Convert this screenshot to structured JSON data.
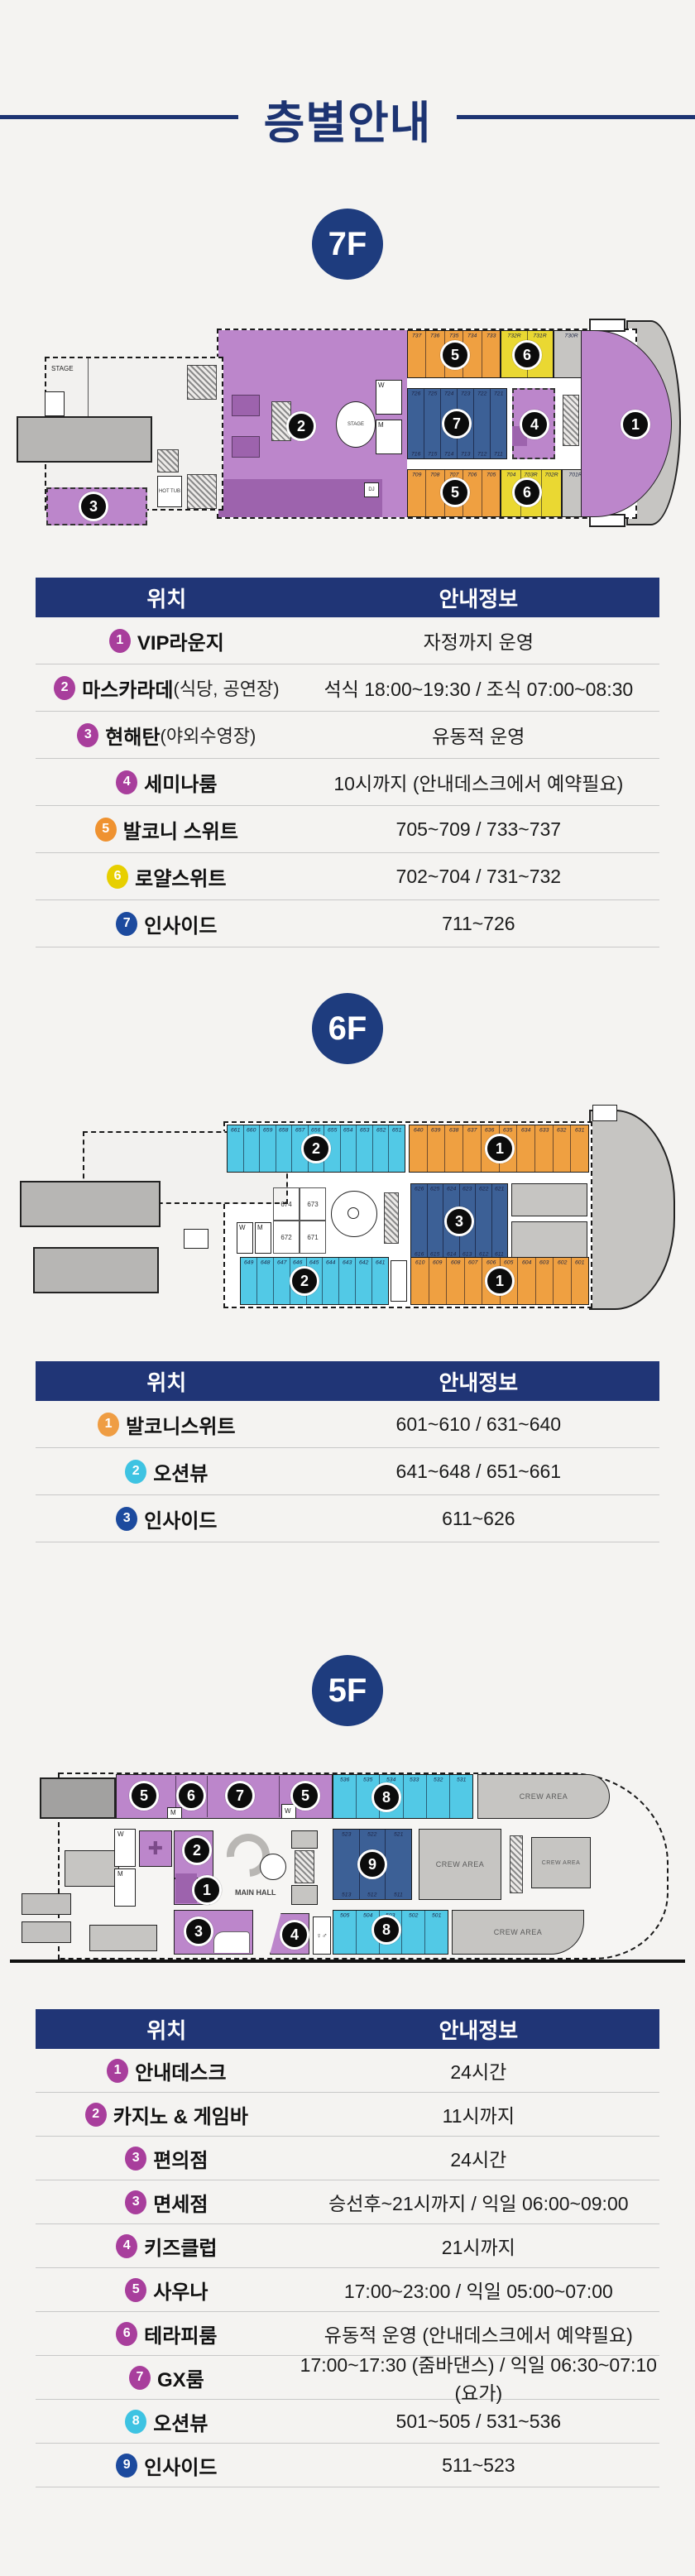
{
  "page": {
    "title": "층별안내"
  },
  "table_headers": {
    "location": "위치",
    "info": "안내정보"
  },
  "decks": {
    "f7": {
      "badge": "7F",
      "rows": [
        {
          "num": "1",
          "color": "#a83e9c",
          "name": "VIP라운지",
          "sub": "",
          "info": "자정까지 운영"
        },
        {
          "num": "2",
          "color": "#a83e9c",
          "name": "마스카라데",
          "sub": "(식당, 공연장)",
          "info": "석식 18:00~19:30 / 조식 07:00~08:30"
        },
        {
          "num": "3",
          "color": "#a83e9c",
          "name": "현해탄",
          "sub": "(야외수영장)",
          "info": "유동적 운영"
        },
        {
          "num": "4",
          "color": "#a83e9c",
          "name": "세미나룸",
          "sub": "",
          "info": "10시까지 (안내데스크에서 예약필요)"
        },
        {
          "num": "5",
          "color": "#ef9230",
          "name": "발코니 스위트",
          "sub": "",
          "info": "705~709 / 733~737"
        },
        {
          "num": "6",
          "color": "#e7cf00",
          "name": "로얄스위트",
          "sub": "",
          "info": "702~704 / 731~732"
        },
        {
          "num": "7",
          "color": "#1c4a9e",
          "name": "인사이드",
          "sub": "",
          "info": "711~726"
        }
      ],
      "plan": {
        "labels": {
          "stage": "STAGE",
          "hot_tub": "HOT TUB",
          "dj": "DJ",
          "w": "W",
          "m": "M"
        },
        "cabins": {
          "top_balcony": [
            "737",
            "736",
            "735",
            "734",
            "733"
          ],
          "top_royal": [
            "732R",
            "731R"
          ],
          "top_gray": [
            "730R"
          ],
          "inside_top": [
            "726",
            "725",
            "724",
            "723",
            "722",
            "721"
          ],
          "inside_bottom": [
            "716",
            "715",
            "714",
            "713",
            "712",
            "711"
          ],
          "bottom_balcony": [
            "709",
            "708",
            "707",
            "706",
            "705"
          ],
          "bottom_royal": [
            "704",
            "703R",
            "702R"
          ],
          "bottom_gray": [
            "701R"
          ]
        }
      }
    },
    "f6": {
      "badge": "6F",
      "rows": [
        {
          "num": "1",
          "color": "#ef9d43",
          "name": "발코니스위트",
          "sub": "",
          "info": "601~610 / 631~640"
        },
        {
          "num": "2",
          "color": "#3ec3e2",
          "name": "오션뷰",
          "sub": "",
          "info": "641~648 / 651~661"
        },
        {
          "num": "3",
          "color": "#1c4a9e",
          "name": "인사이드",
          "sub": "",
          "info": "611~626"
        }
      ],
      "plan": {
        "labels": {
          "w": "W",
          "m": "M"
        },
        "cabins": {
          "top_ocean": [
            "661",
            "660",
            "659",
            "658",
            "657",
            "656",
            "655",
            "654",
            "653",
            "652",
            "651"
          ],
          "top_balcony": [
            "640",
            "639",
            "638",
            "637",
            "636",
            "635",
            "634",
            "633",
            "632",
            "631"
          ],
          "inside_top": [
            "626",
            "625",
            "624",
            "623",
            "622",
            "621"
          ],
          "inside_bottom": [
            "616",
            "615",
            "614",
            "613",
            "612",
            "611"
          ],
          "mid_rooms": [
            "674",
            "673",
            "672",
            "671"
          ],
          "bottom_ocean": [
            "649",
            "648",
            "647",
            "646",
            "645",
            "644",
            "643",
            "642",
            "641"
          ],
          "bottom_balcony": [
            "610",
            "609",
            "608",
            "607",
            "606",
            "605",
            "604",
            "603",
            "602",
            "601"
          ]
        }
      }
    },
    "f5": {
      "badge": "5F",
      "rows": [
        {
          "num": "1",
          "color": "#a83e9c",
          "name": "안내데스크",
          "sub": "",
          "info": "24시간"
        },
        {
          "num": "2",
          "color": "#a83e9c",
          "name": "카지노 & 게임바",
          "sub": "",
          "info": "11시까지"
        },
        {
          "num": "3",
          "color": "#a83e9c",
          "name": "편의점",
          "sub": "",
          "info": "24시간"
        },
        {
          "num": "3",
          "color": "#a83e9c",
          "name": "면세점",
          "sub": "",
          "info": "승선후~21시까지 / 익일 06:00~09:00"
        },
        {
          "num": "4",
          "color": "#a83e9c",
          "name": "키즈클럽",
          "sub": "",
          "info": "21시까지"
        },
        {
          "num": "5",
          "color": "#a83e9c",
          "name": "사우나",
          "sub": "",
          "info": "17:00~23:00 / 익일 05:00~07:00"
        },
        {
          "num": "6",
          "color": "#a83e9c",
          "name": "테라피룸",
          "sub": "",
          "info": "유동적 운영 (안내데스크에서 예약필요)"
        },
        {
          "num": "7",
          "color": "#a83e9c",
          "name": "GX룸",
          "sub": "",
          "info": "17:00~17:30 (줌바댄스) / 익일 06:30~07:10 (요가)"
        },
        {
          "num": "8",
          "color": "#3ec3e2",
          "name": "오션뷰",
          "sub": "",
          "info": "501~505 / 531~536"
        },
        {
          "num": "9",
          "color": "#1c4a9e",
          "name": "인사이드",
          "sub": "",
          "info": "511~523"
        }
      ],
      "plan": {
        "labels": {
          "main_hall": "MAIN HALL",
          "crew": "CREW AREA",
          "w": "W",
          "m": "M"
        },
        "cabins": {
          "top_ocean": [
            "536",
            "535",
            "534",
            "533",
            "532",
            "531"
          ],
          "inside_top": [
            "523",
            "522",
            "521"
          ],
          "inside_bottom": [
            "513",
            "512",
            "511"
          ],
          "bottom_ocean": [
            "505",
            "504",
            "503",
            "502",
            "501"
          ]
        }
      }
    }
  }
}
